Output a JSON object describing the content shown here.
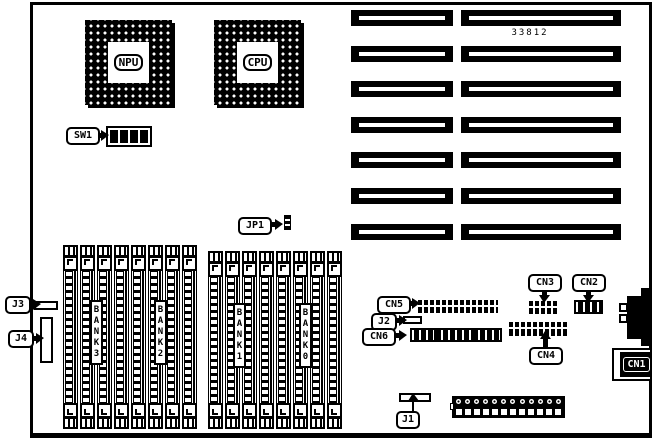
{
  "board": {
    "part_number": "33812",
    "colors": {
      "ink": "#000000",
      "paper": "#ffffff"
    },
    "chips": {
      "npu": "NPU",
      "cpu": "CPU"
    },
    "switch": {
      "label": "SW1",
      "positions": 4
    },
    "jumper": {
      "label": "JP1"
    },
    "expansion_slots": {
      "left_count": 7,
      "right_count": 7
    },
    "memory": {
      "sockets_per_group": 8,
      "banks": [
        {
          "label": "BANK3"
        },
        {
          "label": "BANK2"
        },
        {
          "label": "BANK1"
        },
        {
          "label": "BANK0"
        }
      ]
    },
    "connectors": {
      "j1": "J1",
      "j2": "J2",
      "j3": "J3",
      "j4": "J4",
      "cn1": "CN1",
      "cn2": "CN2",
      "cn3": "CN3",
      "cn4": "CN4",
      "cn5": "CN5",
      "cn6": "CN6"
    },
    "power_connector": {
      "pin_count": 12
    }
  }
}
